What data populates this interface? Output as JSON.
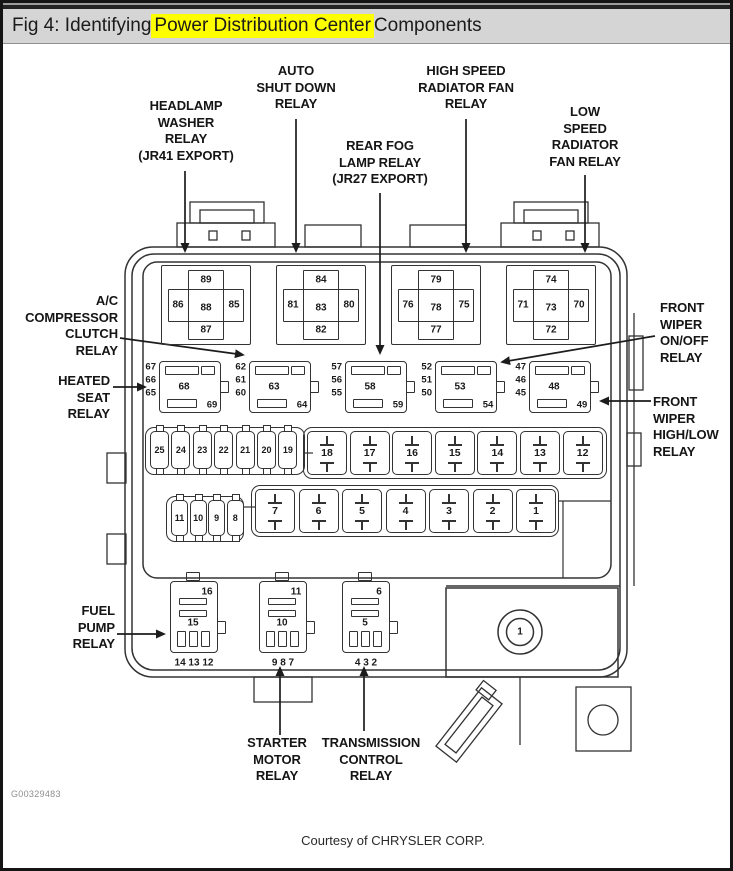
{
  "title": {
    "prefix": "Fig 4: Identifying ",
    "highlight": "Power Distribution Center",
    "suffix": " Components"
  },
  "colors": {
    "highlight": "#ffff00",
    "titlebar_bg": "#d5d5d5",
    "line": "#333333"
  },
  "footer": {
    "figure_code": "G00329483",
    "courtesy": "Courtesy of CHRYSLER CORP."
  },
  "callouts": [
    {
      "id": "headlamp-washer-relay",
      "lines": [
        "HEADLAMP",
        "WASHER",
        "RELAY",
        "(JR41 EXPORT)"
      ]
    },
    {
      "id": "auto-shut-down-relay",
      "lines": [
        "AUTO",
        "SHUT DOWN",
        "RELAY"
      ]
    },
    {
      "id": "rear-fog-lamp-relay",
      "lines": [
        "REAR FOG",
        "LAMP RELAY",
        "(JR27 EXPORT)"
      ]
    },
    {
      "id": "high-speed-radiator-fan-relay",
      "lines": [
        "HIGH SPEED",
        "RADIATOR FAN",
        "RELAY"
      ]
    },
    {
      "id": "low-speed-radiator-fan-relay",
      "lines": [
        "LOW",
        "SPEED",
        "RADIATOR",
        "FAN RELAY"
      ]
    },
    {
      "id": "ac-compressor-clutch-relay",
      "lines": [
        "A/C",
        "COMPRESSOR",
        "CLUTCH",
        "RELAY"
      ]
    },
    {
      "id": "heated-seat-relay",
      "lines": [
        "HEATED",
        "SEAT",
        "RELAY"
      ]
    },
    {
      "id": "front-wiper-on-off-relay",
      "lines": [
        "FRONT",
        "WIPER",
        "ON/OFF",
        "RELAY"
      ]
    },
    {
      "id": "front-wiper-high-low-relay",
      "lines": [
        "FRONT",
        "WIPER",
        "HIGH/LOW",
        "RELAY"
      ]
    },
    {
      "id": "fuel-pump-relay",
      "lines": [
        "FUEL",
        "PUMP",
        "RELAY"
      ]
    },
    {
      "id": "starter-motor-relay",
      "lines": [
        "STARTER",
        "MOTOR",
        "RELAY"
      ]
    },
    {
      "id": "transmission-control-relay",
      "lines": [
        "TRANSMISSION",
        "CONTROL",
        "RELAY"
      ]
    }
  ],
  "pdc": {
    "large_relays": [
      {
        "top": "89",
        "left": "86",
        "center": "88",
        "right": "85",
        "bottom": "87"
      },
      {
        "top": "84",
        "left": "81",
        "center": "83",
        "right": "80",
        "bottom": "82"
      },
      {
        "top": "79",
        "left": "76",
        "center": "78",
        "right": "75",
        "bottom": "77"
      },
      {
        "top": "74",
        "left": "71",
        "center": "73",
        "right": "70",
        "bottom": "72"
      }
    ],
    "mini_relays": [
      {
        "side": [
          "67",
          "66",
          "65"
        ],
        "center": "68",
        "corner": "69"
      },
      {
        "side": [
          "62",
          "61",
          "60"
        ],
        "center": "63",
        "corner": "64"
      },
      {
        "side": [
          "57",
          "56",
          "55"
        ],
        "center": "58",
        "corner": "59"
      },
      {
        "side": [
          "52",
          "51",
          "50"
        ],
        "center": "53",
        "corner": "54"
      },
      {
        "side": [
          "47",
          "46",
          "45"
        ],
        "center": "48",
        "corner": "49"
      }
    ],
    "small_fuses_row1": [
      "25",
      "24",
      "23",
      "22",
      "21",
      "20",
      "19"
    ],
    "small_fuses_row2": [
      "11",
      "10",
      "9",
      "8"
    ],
    "large_fuses_row1": [
      "18",
      "17",
      "16",
      "15",
      "14",
      "13",
      "12"
    ],
    "large_fuses_row2": [
      "7",
      "6",
      "5",
      "4",
      "3",
      "2",
      "1"
    ],
    "bottom_relays": [
      {
        "top": "16",
        "center": "15",
        "pins": "14 13 12"
      },
      {
        "top": "11",
        "center": "10",
        "pins": "9 8 7"
      },
      {
        "top": "6",
        "center": "5",
        "pins": "4 3 2"
      }
    ],
    "cavity_label": "1"
  }
}
